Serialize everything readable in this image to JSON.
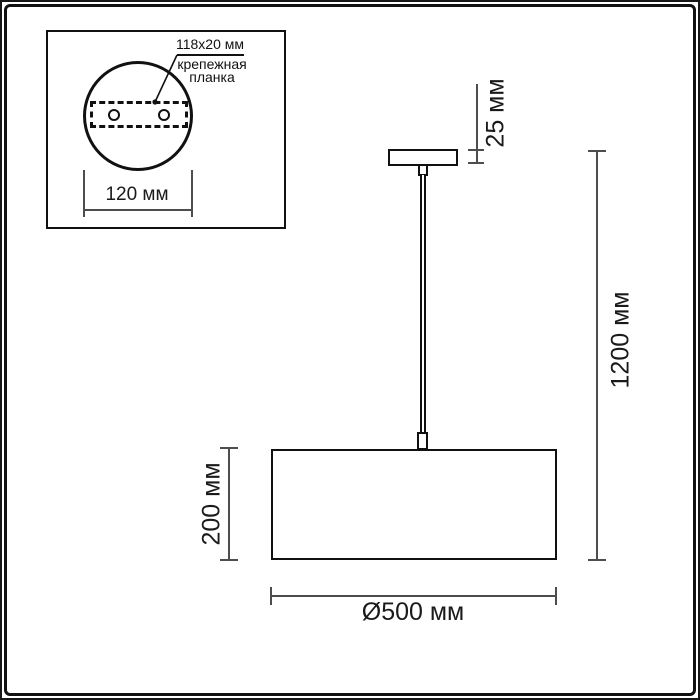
{
  "inset": {
    "bracket_size": "118x20 мм",
    "bracket_name_line1": "крепежная",
    "bracket_name_line2": "планка",
    "plate_width": "120 мм"
  },
  "main": {
    "canopy_height": "25 мм",
    "suspension_height": "1200 мм",
    "shade_height": "200 мм",
    "shade_diameter": "Ø500 мм"
  },
  "colors": {
    "object_line": "#111111",
    "dimension_line": "#4d4d4d",
    "background": "#ffffff"
  }
}
